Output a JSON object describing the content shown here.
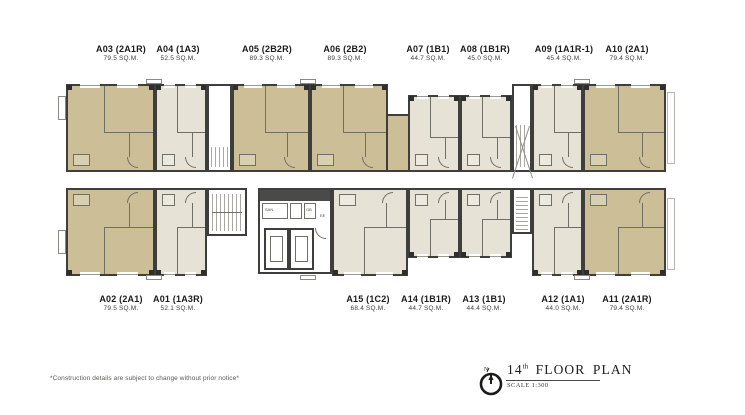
{
  "plan": {
    "colors": {
      "two_bed_fill": "#ccbf97",
      "one_bed_fill": "#e6e2d5",
      "wall": "#3e3e3c",
      "detail_line": "#6f6f68",
      "core_dark": "#4a4a48"
    },
    "units": [
      {
        "id": "A03",
        "type": "2A1R",
        "label": "A03 (2A1R)",
        "sqm": "79.5 SQ.M.",
        "row": "top",
        "color": "tan",
        "x": 66,
        "y": 84,
        "w": 89,
        "h": 88,
        "lx": 121
      },
      {
        "id": "A04",
        "type": "1A3",
        "label": "A04 (1A3)",
        "sqm": "52.5 SQ.M.",
        "row": "top",
        "color": "cream",
        "x": 155,
        "y": 84,
        "w": 52,
        "h": 88,
        "lx": 178
      },
      {
        "id": "A05",
        "type": "2B2R",
        "label": "A05 (2B2R)",
        "sqm": "89.3 SQ.M.",
        "row": "top",
        "color": "tan",
        "x": 232,
        "y": 84,
        "w": 78,
        "h": 88,
        "lx": 267
      },
      {
        "id": "A06",
        "type": "2B2",
        "label": "A06 (2B2)",
        "sqm": "89.3 SQ.M.",
        "row": "top",
        "color": "tan",
        "x": 310,
        "y": 84,
        "w": 78,
        "h": 88,
        "lx": 345
      },
      {
        "id": "A07",
        "type": "1B1",
        "label": "A07 (1B1)",
        "sqm": "44.7 SQ.M.",
        "row": "top",
        "color": "cream",
        "x": 408,
        "y": 95,
        "w": 52,
        "h": 77,
        "lx": 428
      },
      {
        "id": "A08",
        "type": "1B1R",
        "label": "A08 (1B1R)",
        "sqm": "45.0 SQ.M.",
        "row": "top",
        "color": "cream",
        "x": 460,
        "y": 95,
        "w": 52,
        "h": 77,
        "lx": 485
      },
      {
        "id": "A09",
        "type": "1A1R-1",
        "label": "A09 (1A1R-1)",
        "sqm": "45.4 SQ.M.",
        "row": "top",
        "color": "cream",
        "x": 532,
        "y": 84,
        "w": 51,
        "h": 88,
        "lx": 564
      },
      {
        "id": "A10",
        "type": "2A1",
        "label": "A10 (2A1)",
        "sqm": "79.4 SQ.M.",
        "row": "top",
        "color": "tan",
        "x": 583,
        "y": 84,
        "w": 83,
        "h": 88,
        "lx": 627
      },
      {
        "id": "A02",
        "type": "2A1",
        "label": "A02 (2A1)",
        "sqm": "79.5 SQ.M.",
        "row": "bottom",
        "color": "tan",
        "x": 66,
        "y": 188,
        "w": 89,
        "h": 88,
        "lx": 121
      },
      {
        "id": "A01",
        "type": "1A3R",
        "label": "A01 (1A3R)",
        "sqm": "52.1 SQ.M.",
        "row": "bottom",
        "color": "cream",
        "x": 155,
        "y": 188,
        "w": 52,
        "h": 88,
        "lx": 178
      },
      {
        "id": "A15",
        "type": "1C2",
        "label": "A15 (1C2)",
        "sqm": "68.4 SQ.M.",
        "row": "bottom",
        "color": "cream",
        "x": 332,
        "y": 188,
        "w": 76,
        "h": 88,
        "lx": 368
      },
      {
        "id": "A14",
        "type": "1B1R",
        "label": "A14 (1B1R)",
        "sqm": "44.7 SQ.M.",
        "row": "bottom",
        "color": "cream",
        "x": 408,
        "y": 188,
        "w": 52,
        "h": 70,
        "lx": 426
      },
      {
        "id": "A13",
        "type": "1B1",
        "label": "A13 (1B1)",
        "sqm": "44.4 SQ.M.",
        "row": "bottom",
        "color": "cream",
        "x": 460,
        "y": 188,
        "w": 52,
        "h": 70,
        "lx": 484
      },
      {
        "id": "A12",
        "type": "1A1",
        "label": "A12 (1A1)",
        "sqm": "44.0 SQ.M.",
        "row": "bottom",
        "color": "cream",
        "x": 532,
        "y": 188,
        "w": 51,
        "h": 88,
        "lx": 563
      },
      {
        "id": "A11",
        "type": "2A1R",
        "label": "A11 (2A1R)",
        "sqm": "79.4 SQ.M.",
        "row": "bottom",
        "color": "tan",
        "x": 583,
        "y": 188,
        "w": 83,
        "h": 88,
        "lx": 627
      }
    ],
    "core": {
      "san_label": "SAN",
      "gb_label": "GB",
      "ee_label": "EE"
    },
    "title_block": {
      "floor_number": "14",
      "floor_suffix": "th",
      "floor_text": " FLOOR PLAN",
      "scale": "SCALE 1:300",
      "north": "N"
    },
    "disclaimer": "*Construction details are subject to change without prior notice*"
  }
}
